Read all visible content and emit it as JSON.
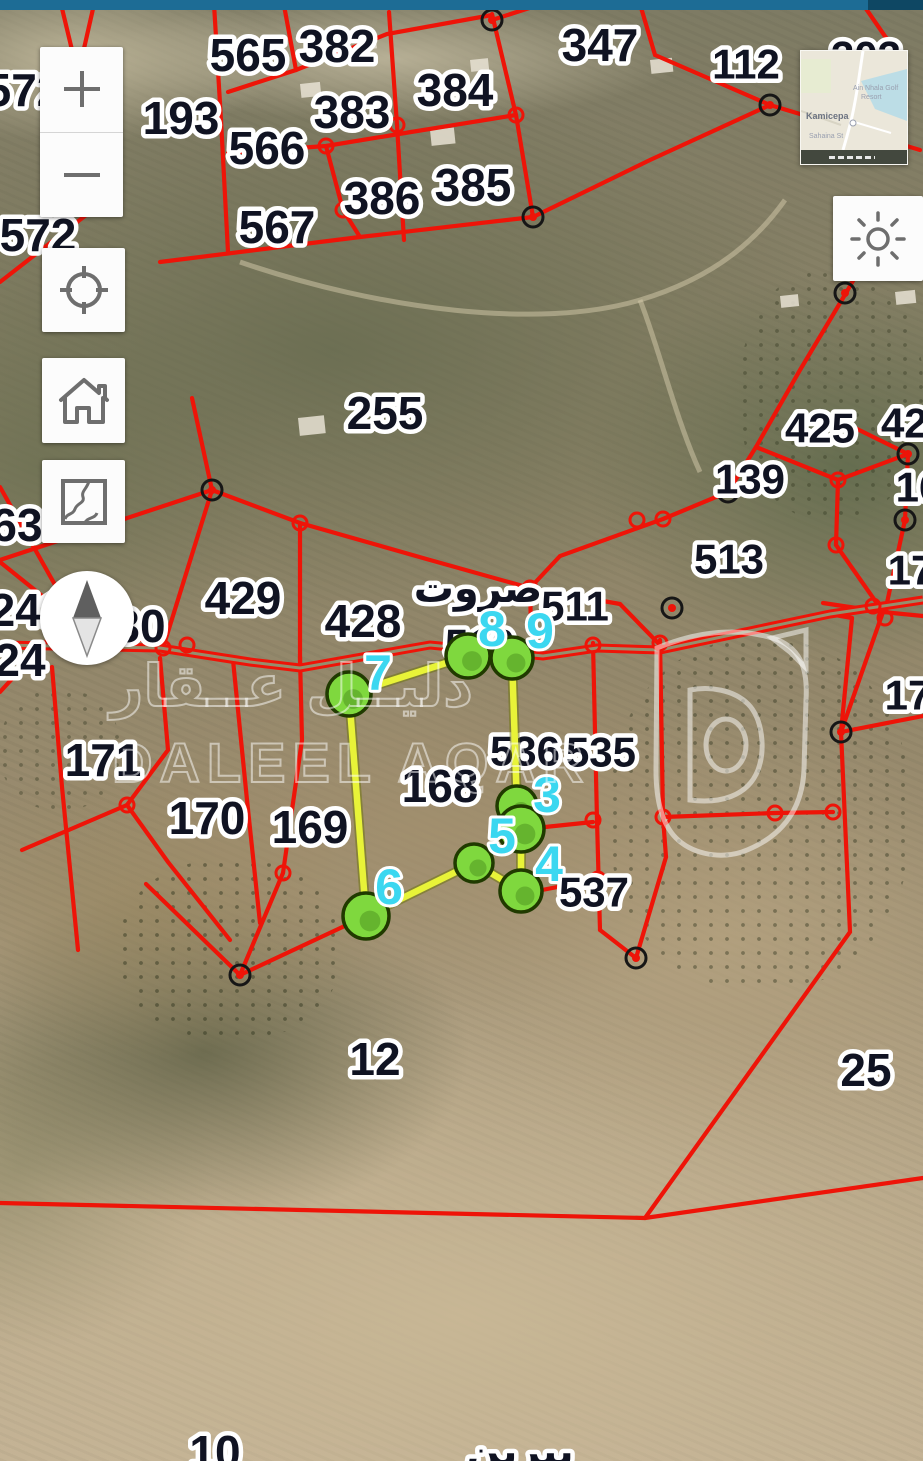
{
  "colors": {
    "topbar": "#1d6c95",
    "topbar_dark": "#0e4763",
    "red": "#ee1408",
    "road_core": "#968e6d",
    "yellow": "#e8f338",
    "yellow_edge": "#6f7510",
    "green_fill": "#7fd83e",
    "green_stroke": "#203a00",
    "cyan": "#3bd7f0",
    "label_fill": "#101322",
    "label_halo": "#ffffff",
    "icon_gray": "#6e6e6e",
    "marker_ring": "#161616"
  },
  "controls": {
    "zoom_in": "+",
    "zoom_out": "−",
    "names": [
      "zoom-in",
      "zoom-out",
      "locate",
      "home",
      "basemap",
      "brightness",
      "compass"
    ]
  },
  "minimap": {
    "town": "Kamicepa",
    "poi_line1": "Ain Nhala Golf",
    "poi_line2": "Resort",
    "street": "Sahaina St"
  },
  "watermark": {
    "arabic": "دليــل عــقار",
    "latin": "DALEEL AQAR"
  },
  "map": {
    "place_labels": [
      {
        "t": "565",
        "x": 248,
        "y": 55
      },
      {
        "t": "382",
        "x": 337,
        "y": 46
      },
      {
        "t": "384",
        "x": 455,
        "y": 90
      },
      {
        "t": "383",
        "x": 352,
        "y": 112
      },
      {
        "t": "193",
        "x": 181,
        "y": 118
      },
      {
        "t": "566",
        "x": 267,
        "y": 148
      },
      {
        "t": "386",
        "x": 382,
        "y": 198
      },
      {
        "t": "385",
        "x": 473,
        "y": 185
      },
      {
        "t": "567",
        "x": 277,
        "y": 227
      },
      {
        "t": "347",
        "x": 600,
        "y": 45
      },
      {
        "t": "112",
        "x": 746,
        "y": 64,
        "fs": 42
      },
      {
        "t": "303",
        "x": 866,
        "y": 56,
        "fs": 42
      },
      {
        "t": "572",
        "x": 24,
        "y": 90
      },
      {
        "t": "572",
        "x": 38,
        "y": 235
      },
      {
        "t": "255",
        "x": 385,
        "y": 413
      },
      {
        "t": "425",
        "x": 820,
        "y": 428,
        "fs": 42
      },
      {
        "t": "425",
        "x": 916,
        "y": 423,
        "fs": 42
      },
      {
        "t": "139",
        "x": 750,
        "y": 479,
        "fs": 42
      },
      {
        "t": "513",
        "x": 729,
        "y": 559,
        "fs": 42
      },
      {
        "t": "511",
        "x": 575,
        "y": 606,
        "fs": 42
      },
      {
        "t": "510",
        "x": 480,
        "y": 644,
        "fs": 42
      },
      {
        "t": "429",
        "x": 243,
        "y": 598
      },
      {
        "t": "428",
        "x": 363,
        "y": 621
      },
      {
        "t": "30",
        "x": 140,
        "y": 626
      },
      {
        "t": "63",
        "x": 17,
        "y": 525
      },
      {
        "t": "241",
        "x": 28,
        "y": 610
      },
      {
        "t": "24",
        "x": 20,
        "y": 660
      },
      {
        "t": "171",
        "x": 103,
        "y": 760
      },
      {
        "t": "170",
        "x": 207,
        "y": 818
      },
      {
        "t": "169",
        "x": 310,
        "y": 827
      },
      {
        "t": "168",
        "x": 440,
        "y": 786
      },
      {
        "t": "536",
        "x": 525,
        "y": 751,
        "fs": 42
      },
      {
        "t": "535",
        "x": 601,
        "y": 752,
        "fs": 42
      },
      {
        "t": "537",
        "x": 594,
        "y": 892,
        "fs": 42
      },
      {
        "t": "12",
        "x": 375,
        "y": 1059
      },
      {
        "t": "25",
        "x": 866,
        "y": 1070
      },
      {
        "t": "10",
        "x": 215,
        "y": 1452
      },
      {
        "t": "16",
        "x": 919,
        "y": 487,
        "fs": 42
      },
      {
        "t": "17",
        "x": 911,
        "y": 570,
        "fs": 42
      },
      {
        "t": "17",
        "x": 908,
        "y": 695,
        "fs": 42
      },
      {
        "t": "صروت",
        "x": 478,
        "y": 589,
        "fs": 40,
        "cls": "ar"
      },
      {
        "t": "بيرين",
        "x": 520,
        "y": 1452,
        "fs": 40,
        "cls": "ar"
      }
    ],
    "red_lines": [
      [
        [
          214,
          4
        ],
        [
          221,
          120
        ],
        [
          228,
          252
        ]
      ],
      [
        [
          60,
          0
        ],
        [
          78,
          75
        ],
        [
          90,
          212
        ]
      ],
      [
        [
          95,
          0
        ],
        [
          78,
          75
        ]
      ],
      [
        [
          0,
          282
        ],
        [
          90,
          212
        ]
      ],
      [
        [
          283,
          0
        ],
        [
          296,
          70
        ]
      ],
      [
        [
          389,
          12
        ],
        [
          397,
          125
        ],
        [
          404,
          240
        ]
      ],
      [
        [
          492,
          14
        ],
        [
          516,
          115
        ],
        [
          533,
          217
        ]
      ],
      [
        [
          228,
          92
        ],
        [
          296,
          70
        ],
        [
          387,
          34
        ],
        [
          492,
          15
        ]
      ],
      [
        [
          228,
          153
        ],
        [
          326,
          146
        ],
        [
          411,
          132
        ],
        [
          516,
          115
        ]
      ],
      [
        [
          326,
          146
        ],
        [
          343,
          210
        ],
        [
          360,
          237
        ]
      ],
      [
        [
          160,
          262
        ],
        [
          360,
          237
        ],
        [
          533,
          217
        ]
      ],
      [
        [
          533,
          217
        ],
        [
          650,
          160
        ],
        [
          770,
          105
        ]
      ],
      [
        [
          770,
          105
        ],
        [
          655,
          55
        ],
        [
          640,
          4
        ]
      ],
      [
        [
          770,
          105
        ],
        [
          920,
          150
        ]
      ],
      [
        [
          492,
          20
        ],
        [
          548,
          2
        ]
      ],
      [
        [
          860,
          0
        ],
        [
          900,
          58
        ]
      ],
      [
        [
          846,
          293
        ],
        [
          800,
          370
        ],
        [
          756,
          447
        ]
      ],
      [
        [
          846,
          293
        ],
        [
          885,
          225
        ]
      ],
      [
        [
          756,
          447
        ],
        [
          728,
          492
        ]
      ],
      [
        [
          728,
          492
        ],
        [
          663,
          519
        ]
      ],
      [
        [
          663,
          519
        ],
        [
          560,
          556
        ],
        [
          530,
          588
        ]
      ],
      [
        [
          756,
          447
        ],
        [
          838,
          480
        ]
      ],
      [
        [
          838,
          480
        ],
        [
          908,
          454
        ]
      ],
      [
        [
          908,
          454
        ],
        [
          855,
          428
        ]
      ],
      [
        [
          908,
          454
        ],
        [
          905,
          520
        ],
        [
          885,
          612
        ]
      ],
      [
        [
          838,
          480
        ],
        [
          836,
          545
        ],
        [
          883,
          612
        ]
      ],
      [
        [
          823,
          603
        ],
        [
          883,
          612
        ],
        [
          923,
          616
        ]
      ],
      [
        [
          883,
          612
        ],
        [
          841,
          732
        ]
      ],
      [
        [
          841,
          732
        ],
        [
          923,
          716
        ]
      ],
      [
        [
          841,
          732
        ],
        [
          850,
          932
        ],
        [
          645,
          1218
        ]
      ],
      [
        [
          0,
          1203
        ],
        [
          645,
          1218
        ],
        [
          923,
          1178
        ]
      ],
      [
        [
          212,
          490
        ],
        [
          163,
          648
        ]
      ],
      [
        [
          212,
          490
        ],
        [
          300,
          523
        ]
      ],
      [
        [
          300,
          523
        ],
        [
          300,
          668
        ]
      ],
      [
        [
          300,
          523
        ],
        [
          430,
          560
        ],
        [
          530,
          588
        ]
      ],
      [
        [
          530,
          588
        ],
        [
          531,
          628
        ]
      ],
      [
        [
          530,
          588
        ],
        [
          620,
          604
        ],
        [
          660,
          645
        ]
      ],
      [
        [
          212,
          490
        ],
        [
          0,
          560
        ]
      ],
      [
        [
          212,
          490
        ],
        [
          192,
          398
        ]
      ],
      [
        [
          0,
          487
        ],
        [
          68,
          608
        ]
      ],
      [
        [
          0,
          562
        ],
        [
          66,
          615
        ]
      ],
      [
        [
          0,
          692
        ],
        [
          64,
          622
        ]
      ],
      [
        [
          66,
          612
        ],
        [
          163,
          648
        ]
      ],
      [
        [
          52,
          667
        ],
        [
          62,
          787
        ],
        [
          78,
          950
        ]
      ],
      [
        [
          160,
          658
        ],
        [
          168,
          750
        ],
        [
          127,
          805
        ]
      ],
      [
        [
          127,
          805
        ],
        [
          22,
          850
        ]
      ],
      [
        [
          127,
          805
        ],
        [
          168,
          862
        ],
        [
          230,
          940
        ]
      ],
      [
        [
          233,
          660
        ],
        [
          247,
          800
        ],
        [
          260,
          923
        ]
      ],
      [
        [
          300,
          657
        ],
        [
          302,
          740
        ],
        [
          283,
          873
        ]
      ],
      [
        [
          283,
          873
        ],
        [
          240,
          975
        ]
      ],
      [
        [
          366,
          916
        ],
        [
          240,
          975
        ]
      ],
      [
        [
          240,
          975
        ],
        [
          146,
          884
        ]
      ],
      [
        [
          593,
          643
        ],
        [
          597,
          820
        ],
        [
          600,
          930
        ]
      ],
      [
        [
          660,
          640
        ],
        [
          663,
          817
        ],
        [
          666,
          857
        ]
      ],
      [
        [
          663,
          817
        ],
        [
          775,
          813
        ],
        [
          833,
          812
        ]
      ],
      [
        [
          593,
          822
        ],
        [
          545,
          827
        ]
      ],
      [
        [
          542,
          890
        ],
        [
          593,
          880
        ]
      ],
      [
        [
          666,
          857
        ],
        [
          636,
          958
        ]
      ],
      [
        [
          636,
          958
        ],
        [
          600,
          930
        ]
      ],
      [
        [
          852,
          618
        ],
        [
          841,
          732
        ]
      ],
      [
        [
          830,
          614
        ],
        [
          852,
          618
        ]
      ]
    ],
    "road": [
      [
        0,
        645
      ],
      [
        160,
        648
      ],
      [
        250,
        662
      ],
      [
        300,
        668
      ],
      [
        430,
        645
      ],
      [
        543,
        656
      ],
      [
        597,
        648
      ],
      [
        660,
        650
      ],
      [
        830,
        614
      ],
      [
        923,
        600
      ]
    ],
    "open_circles": [
      [
        163,
        648
      ],
      [
        187,
        645
      ],
      [
        300,
        523
      ],
      [
        326,
        146
      ],
      [
        530,
        588
      ],
      [
        637,
        520
      ],
      [
        663,
        519
      ],
      [
        593,
        645
      ],
      [
        660,
        643
      ],
      [
        593,
        820
      ],
      [
        663,
        817
      ],
      [
        775,
        813
      ],
      [
        833,
        812
      ],
      [
        838,
        480
      ],
      [
        836,
        545
      ],
      [
        873,
        606
      ],
      [
        885,
        618
      ],
      [
        598,
        879
      ],
      [
        283,
        873
      ],
      [
        127,
        805
      ],
      [
        397,
        125
      ],
      [
        516,
        115
      ],
      [
        343,
        210
      ]
    ],
    "survey_markers": [
      [
        492,
        20
      ],
      [
        770,
        105
      ],
      [
        533,
        217
      ],
      [
        845,
        293
      ],
      [
        728,
        492
      ],
      [
        212,
        490
      ],
      [
        908,
        454
      ],
      [
        905,
        520
      ],
      [
        672,
        608
      ],
      [
        841,
        732
      ],
      [
        636,
        958
      ],
      [
        240,
        975
      ]
    ],
    "highlight": {
      "polygon": [
        [
          349,
          694
        ],
        [
          468,
          656
        ],
        [
          512,
          658
        ],
        [
          517,
          806
        ],
        [
          521,
          829
        ],
        [
          521,
          891
        ],
        [
          474,
          863
        ],
        [
          366,
          916
        ]
      ],
      "vertices": [
        {
          "n": "7",
          "x": 349,
          "y": 694,
          "r": 22
        },
        {
          "n": "8",
          "x": 468,
          "y": 656,
          "r": 22
        },
        {
          "n": "9",
          "x": 512,
          "y": 658,
          "r": 21
        },
        {
          "n": "3",
          "x": 517,
          "y": 806,
          "r": 20
        },
        {
          "n": "5",
          "x": 521,
          "y": 829,
          "r": 23
        },
        {
          "n": "",
          "x": 474,
          "y": 863,
          "r": 19
        },
        {
          "n": "4",
          "x": 521,
          "y": 891,
          "r": 21
        },
        {
          "n": "6",
          "x": 366,
          "y": 916,
          "r": 23
        }
      ],
      "vertex_labels": [
        {
          "t": "7",
          "x": 378,
          "y": 673
        },
        {
          "t": "8",
          "x": 492,
          "y": 629
        },
        {
          "t": "9",
          "x": 540,
          "y": 631
        },
        {
          "t": "3",
          "x": 547,
          "y": 795
        },
        {
          "t": "5",
          "x": 502,
          "y": 836
        },
        {
          "t": "4",
          "x": 549,
          "y": 864
        },
        {
          "t": "6",
          "x": 389,
          "y": 887
        }
      ]
    },
    "decor": {
      "tracks": [
        "M240,262 C380,310 540,330 640,300 C720,276 760,235 785,200",
        "M640,300 C658,345 676,420 700,472"
      ],
      "buildings": [
        [
          298,
          418,
          26,
          18
        ],
        [
          300,
          84,
          20,
          14
        ],
        [
          430,
          130,
          24,
          16
        ],
        [
          470,
          60,
          18,
          12
        ],
        [
          650,
          60,
          22,
          14
        ],
        [
          360,
          40,
          16,
          10
        ],
        [
          780,
          296,
          18,
          12
        ],
        [
          895,
          292,
          20,
          13
        ]
      ]
    }
  }
}
